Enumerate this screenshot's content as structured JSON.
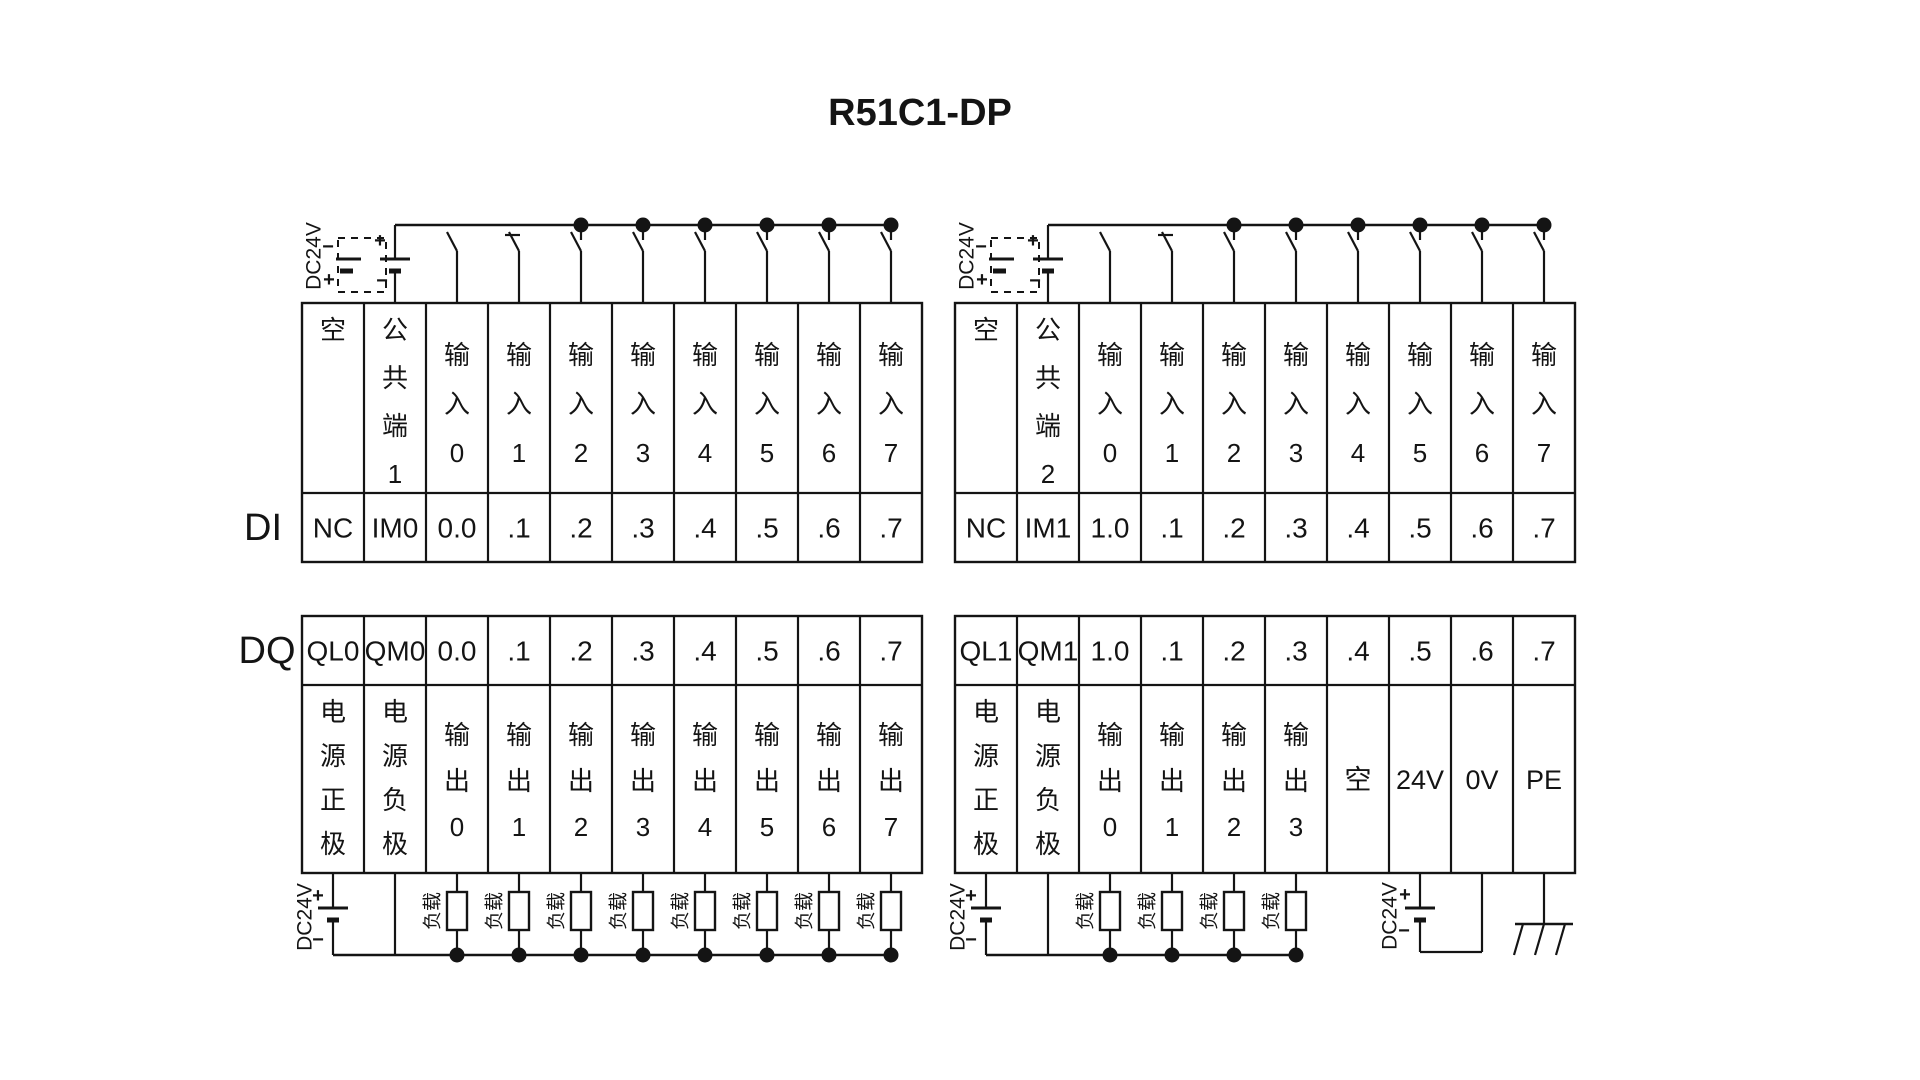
{
  "title": "R51C1-DP",
  "colors": {
    "line": "#141414",
    "background": "#ffffff",
    "text": "#141414"
  },
  "sections": {
    "di": {
      "label": "DI",
      "blocks": [
        {
          "supply": {
            "label": "DC24V",
            "plus": "+",
            "minus": "−"
          },
          "columns": [
            {
              "header": "空",
              "terminal": "NC"
            },
            {
              "header": "公共端1",
              "terminal": "IM0"
            },
            {
              "header": "输入0",
              "terminal": "0.0"
            },
            {
              "header": "输入1",
              "terminal": ".1"
            },
            {
              "header": "输入2",
              "terminal": ".2"
            },
            {
              "header": "输入3",
              "terminal": ".3"
            },
            {
              "header": "输入4",
              "terminal": ".4"
            },
            {
              "header": "输入5",
              "terminal": ".5"
            },
            {
              "header": "输入6",
              "terminal": ".6"
            },
            {
              "header": "输入7",
              "terminal": ".7"
            }
          ]
        },
        {
          "supply": {
            "label": "DC24V",
            "plus": "+",
            "minus": "−"
          },
          "columns": [
            {
              "header": "空",
              "terminal": "NC"
            },
            {
              "header": "公共端2",
              "terminal": "IM1"
            },
            {
              "header": "输入0",
              "terminal": "1.0"
            },
            {
              "header": "输入1",
              "terminal": ".1"
            },
            {
              "header": "输入2",
              "terminal": ".2"
            },
            {
              "header": "输入3",
              "terminal": ".3"
            },
            {
              "header": "输入4",
              "terminal": ".4"
            },
            {
              "header": "输入5",
              "terminal": ".5"
            },
            {
              "header": "输入6",
              "terminal": ".6"
            },
            {
              "header": "输入7",
              "terminal": ".7"
            }
          ]
        }
      ]
    },
    "dq": {
      "label": "DQ",
      "load_label": "负载",
      "blocks": [
        {
          "supply": {
            "label": "DC24V",
            "plus": "+",
            "minus": "−"
          },
          "columns": [
            {
              "terminal": "QL0",
              "body": "电源正极",
              "role": "plus"
            },
            {
              "terminal": "QM0",
              "body": "电源负极",
              "role": "minus"
            },
            {
              "terminal": "0.0",
              "body": "输出0",
              "role": "load"
            },
            {
              "terminal": ".1",
              "body": "输出1",
              "role": "load"
            },
            {
              "terminal": ".2",
              "body": "输出2",
              "role": "load"
            },
            {
              "terminal": ".3",
              "body": "输出3",
              "role": "load"
            },
            {
              "terminal": ".4",
              "body": "输出4",
              "role": "load"
            },
            {
              "terminal": ".5",
              "body": "输出5",
              "role": "load"
            },
            {
              "terminal": ".6",
              "body": "输出6",
              "role": "load"
            },
            {
              "terminal": ".7",
              "body": "输出7",
              "role": "load"
            }
          ]
        },
        {
          "supply": {
            "label": "DC24V",
            "plus": "+",
            "minus": "−"
          },
          "aux_supply": {
            "label": "DC24V",
            "plus": "+",
            "minus": "−"
          },
          "columns": [
            {
              "terminal": "QL1",
              "body": "电源正极",
              "role": "plus"
            },
            {
              "terminal": "QM1",
              "body": "电源负极",
              "role": "minus"
            },
            {
              "terminal": "1.0",
              "body": "输出0",
              "role": "load"
            },
            {
              "terminal": ".1",
              "body": "输出1",
              "role": "load"
            },
            {
              "terminal": ".2",
              "body": "输出2",
              "role": "load"
            },
            {
              "terminal": ".3",
              "body": "输出3",
              "role": "load"
            },
            {
              "terminal": ".4",
              "body": "空",
              "role": "blank"
            },
            {
              "terminal": ".5",
              "body": "24V",
              "role": "v24"
            },
            {
              "terminal": ".6",
              "body": "0V",
              "role": "v0"
            },
            {
              "terminal": ".7",
              "body": "PE",
              "role": "pe"
            }
          ]
        }
      ]
    }
  }
}
